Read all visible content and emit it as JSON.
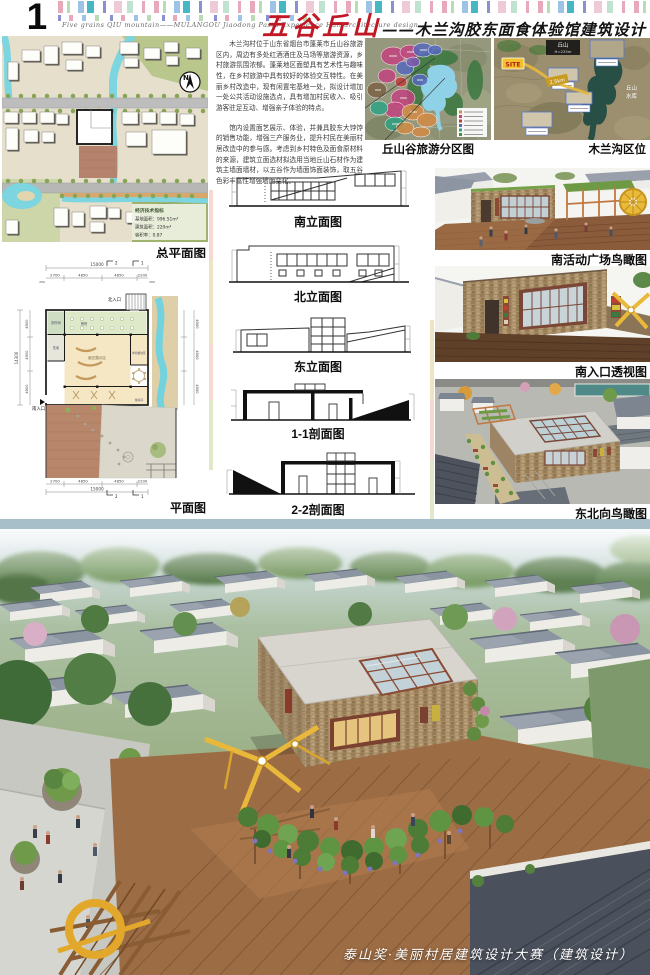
{
  "page": {
    "number": "01",
    "subtitle_en": "Five grains QIU mountain——MULANGOU Jiaodong Pasta Experience Hall architecture design",
    "title_red": "五谷丘山",
    "title_black": "——木兰沟胶东面食体验馆建筑设计",
    "footer": "泰山奖·美丽村居建筑设计大赛（建筑设计）"
  },
  "intro": {
    "p1": "木兰沟村位于山东省烟台市蓬莱市丘山谷旅游区内，周边有多处红酒酒庄及马场等旅游资源，乡村旅游氛围浓郁。蓬莱地区面塑具有艺术性与趣味性，在乡村旅游中具有较好的体验交互特性。在美丽乡村改造中，现有闲置宅基地一处，拟设计增加一处公共活动设施选点，具有增加村民收入、吸引游客驻足互动、增强亲子体验的特点。",
    "p2": "馆内设置面艺展示、体验，并兼具胶东大饽饽的销售功能，增强三产服务业，提升村民在美丽村居改造中的参与感。考虑到乡村特色及面食原材料的来源，建筑立面选材拟选用当地丘山石材作为建筑主墙面墙材，以五谷作为墙面饰面装饰，取五谷色彩丰富性增强墙面变化。"
  },
  "site_plan": {
    "label": "总平面图",
    "north": "N",
    "eco_title": "经济技术指标",
    "eco_rows": [
      "基地面积：996.51m²",
      "建筑面积：220m²",
      "容积率：0.87"
    ]
  },
  "floor_plan": {
    "label": "平面图",
    "north_entrance": "北入口",
    "south_entrance": "南入口",
    "dim_total": "15000",
    "dim_total_v": "14300",
    "dim_edge": "200",
    "dims_h": [
      "2700",
      "4850",
      "4850",
      "2200"
    ],
    "dims_v": [
      "4500",
      "4900",
      "4500"
    ],
    "marks": {
      "s1": "1",
      "s2": "2"
    },
    "rooms": [
      "制作间",
      "售卖",
      "餐吧",
      "面艺展示区",
      "体验餐饮区",
      "餐具间"
    ]
  },
  "drawings": {
    "south": "南立面图",
    "north": "北立面图",
    "east": "东立面图",
    "sec11": "1-1剖面图",
    "sec22": "2-2剖面图"
  },
  "maps": {
    "zoning_label": "丘山谷旅游分区图",
    "location_label": "木兰沟区位",
    "location": {
      "site": "SITE",
      "distance": "2.5km",
      "peak": "丘山",
      "peak_elev": "H=225m",
      "reservoir_l1": "丘山",
      "reservoir_l2": "水库"
    }
  },
  "renders": {
    "r1": "南活动广场鸟瞰图",
    "r2": "南入口透视图",
    "r3": "东北向鸟瞰图"
  },
  "colors": {
    "accent_red": "#c01824",
    "divider_blue": "#a7bfc9",
    "stone": "#a8906c",
    "deck": "#9a6a42"
  }
}
